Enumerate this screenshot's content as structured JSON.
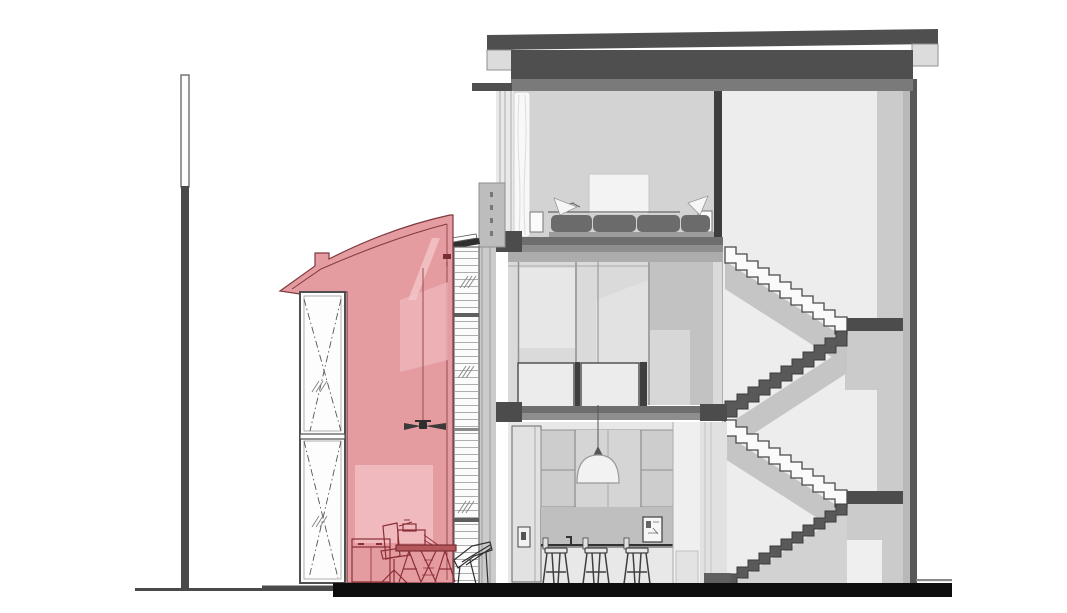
{
  "document": {
    "type": "architectural-section-drawing",
    "description": "Cross-section of a three-level house with highlighted curved-roof annex, stair, bedroom, mezzanine and kitchen",
    "highlighted_element": "annex-section",
    "visible_counts": {
      "stair_flights": 4,
      "stair_landings": 2,
      "bar_stools": 3,
      "annex_window_panes": 2,
      "bed_pillows": 4
    }
  },
  "colors": {
    "bg": "#ffffff",
    "ink": "#4a4a4a",
    "ground_bar": "#0d0d0d",
    "ground_line": "#4a4a4a",
    "pole_dark": "#4a4a4a",
    "pole_light": "#fdfdfd",
    "roof_dark": "#4f4f4f",
    "roof_mid": "#7a7a7a",
    "fascia": "#dcdcdc",
    "wall_cut": "#585858",
    "wall_inner": "#b9b9b9",
    "wall_strip": "#cbcbcb",
    "hall_bg": "#ededed",
    "band": "#cbcbcb",
    "band_light": "#efefef",
    "slab_dark": "#4c4c4c",
    "slab_top": "#6e6e6e",
    "slab_bottom": "#8e8e8e",
    "bedroom_wall": "#d3d3d3",
    "curtain": "#f8f8f8",
    "headboard": "#f3f3f3",
    "pillow": "#6b6b6b",
    "bed_platform": "#9c9c9c",
    "nightstand": "#fbfbfb",
    "mezz_bg": "#dadada",
    "mezz_trim": "#acacac",
    "mezz_col": "#c2c2c2",
    "balustrade": "#ececec",
    "post_dark": "#3f3f3f",
    "kitchen_bg": "#e8e8e8",
    "fridge": "#e2e2e2",
    "cabinet": "#cdcdcd",
    "cabinet_mid": "#d5d5d5",
    "wall_band": "#bfbfbf",
    "lamp_shade": "#f2f2f2",
    "frame_white": "#f6f6f6",
    "stool_fill": "#e8e8e8",
    "tread_light": "#fafafa",
    "tread_dark": "#595959",
    "stair_shadow": "#c5c5c5",
    "under_stair": "#d2d2d2",
    "louver_face": "#fbfbfb",
    "louver_cap": "#2f2f2f",
    "pink": "#e59ca0",
    "pink_light": "#efb9bd",
    "pink_streak": "#f3c6c9",
    "pink_outline": "#7e3a3f",
    "furn_red": "#8b2f36",
    "furn_fill": "#e7a2a6",
    "desk_top": "#b5565c",
    "fan_dark": "#3a3a3a",
    "tag_red": "#7a2e33",
    "mullion_dark": "#3e3e3e"
  }
}
